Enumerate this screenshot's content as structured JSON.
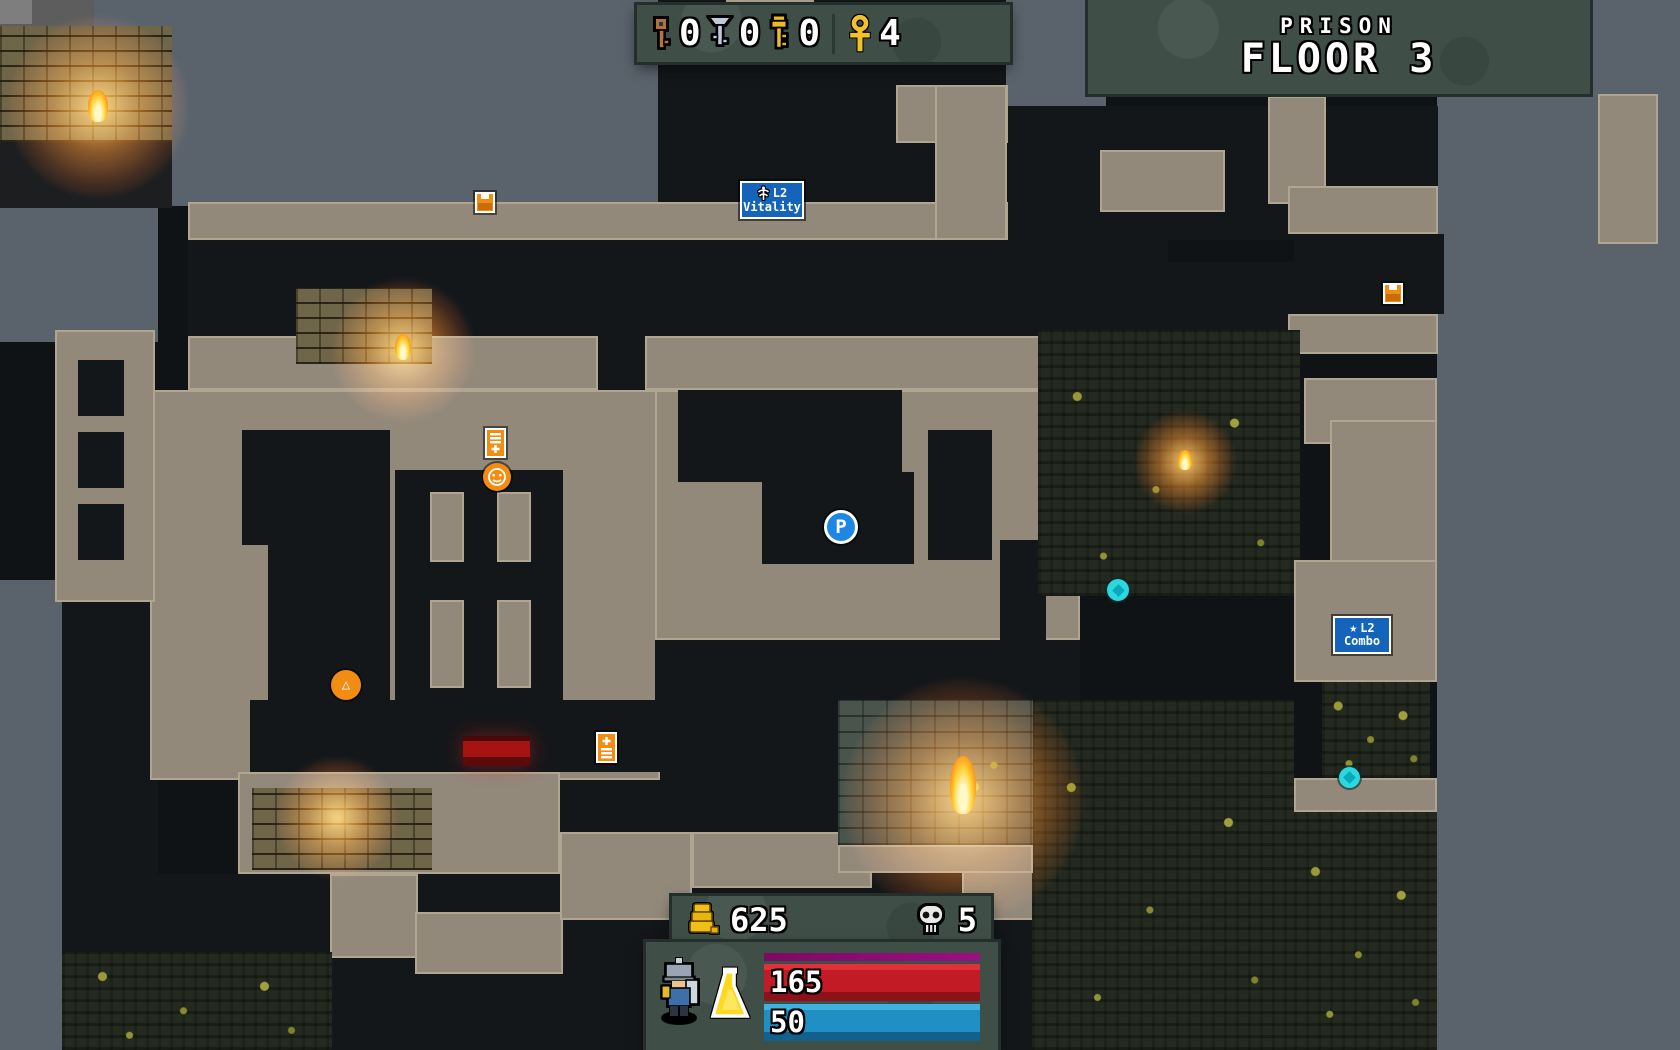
{
  "floor_panel": {
    "zone_name": "PRISON",
    "floor_label": "FLOOR 3"
  },
  "top_hud": {
    "bronze_key_count": "0",
    "silver_key_count": "0",
    "gold_key_count": "0",
    "ankh_count": "4"
  },
  "bottom_hud": {
    "gold": "625",
    "skulls": "5",
    "health": "165",
    "mana": "50"
  },
  "map_markers": {
    "player_label": "P",
    "vitality_sign": {
      "level": "L2",
      "name": "Vitality"
    },
    "combo_sign": {
      "level": "L2",
      "name": "Combo",
      "icon_glyph": "★"
    },
    "mine_glyph": "△"
  },
  "colors": {
    "health_bar": "#c21b25",
    "mana_bar": "#1f8fc4",
    "xp_bar": "#8d0e74",
    "hud_panel": "#3f4f48",
    "fog": "#5a636c",
    "wall_tan": "#93897b",
    "marker_orange": "#f28c12",
    "sign_blue": "#1464bc",
    "player_blue": "#1e87e5",
    "gem_cyan": "#2ad8e0",
    "door_red": "#a61313"
  }
}
